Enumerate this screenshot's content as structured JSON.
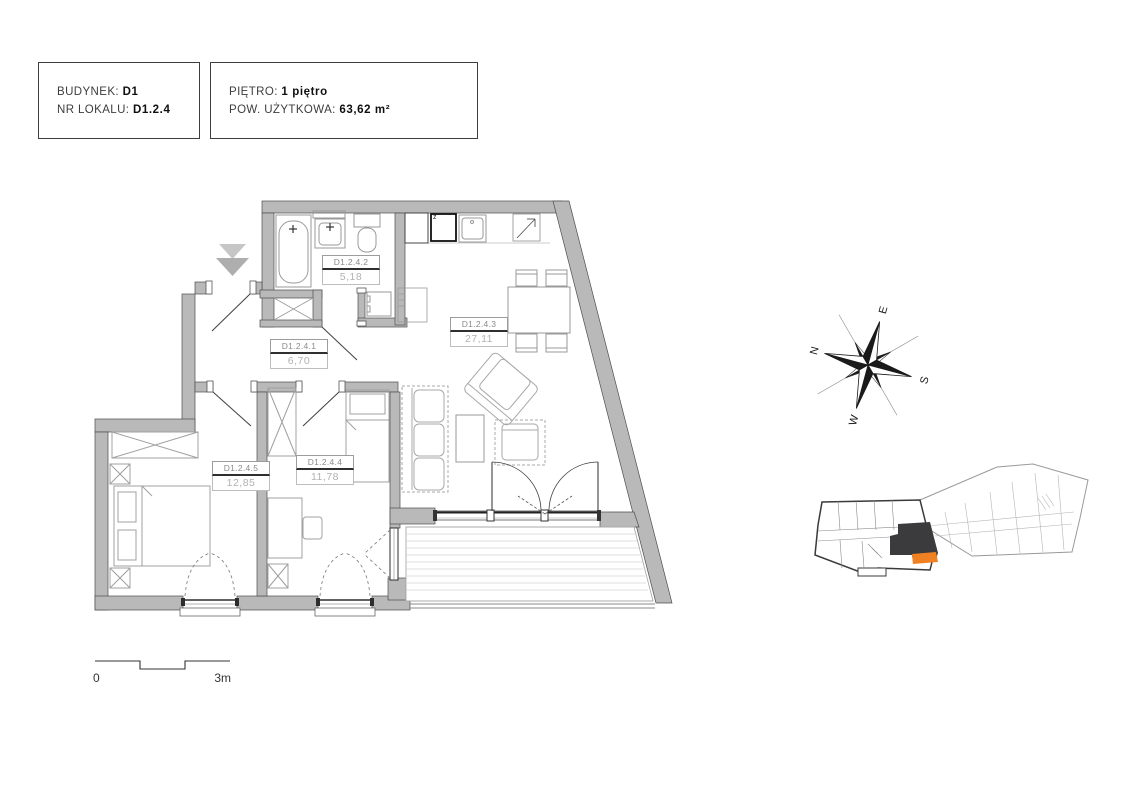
{
  "header": {
    "box1": {
      "line1_label": "BUDYNEK: ",
      "line1_value": "D1",
      "line2_label": "NR LOKALU: ",
      "line2_value": "D1.2.4"
    },
    "box2": {
      "line1_label": "PIĘTRO: ",
      "line1_value": "1 piętro",
      "line2_label": "POW. UŻYTKOWA: ",
      "line2_value": "63,62 m²"
    }
  },
  "plan": {
    "rooms": [
      {
        "id": "D1.2.4.1",
        "area": "6,70"
      },
      {
        "id": "D1.2.4.2",
        "area": "5,18"
      },
      {
        "id": "D1.2.4.3",
        "area": "27,11"
      },
      {
        "id": "D1.2.4.4",
        "area": "11,78"
      },
      {
        "id": "D1.2.4.5",
        "area": "12,85"
      }
    ],
    "kitchen_appliance_label": "z"
  },
  "compass": {
    "n": "N",
    "e": "E",
    "s": "S",
    "w": "W"
  },
  "scale_bar": {
    "start": "0",
    "end": "3m"
  },
  "colors": {
    "wall": "#b9b9b9",
    "wall_outline": "#4e4e4e",
    "furniture": "#a0a0a0",
    "label_text": "#8a8a8a",
    "area_text": "#b2b2b2",
    "highlight_unit": "#3b3b3d",
    "highlight_balcony": "#f08122"
  }
}
